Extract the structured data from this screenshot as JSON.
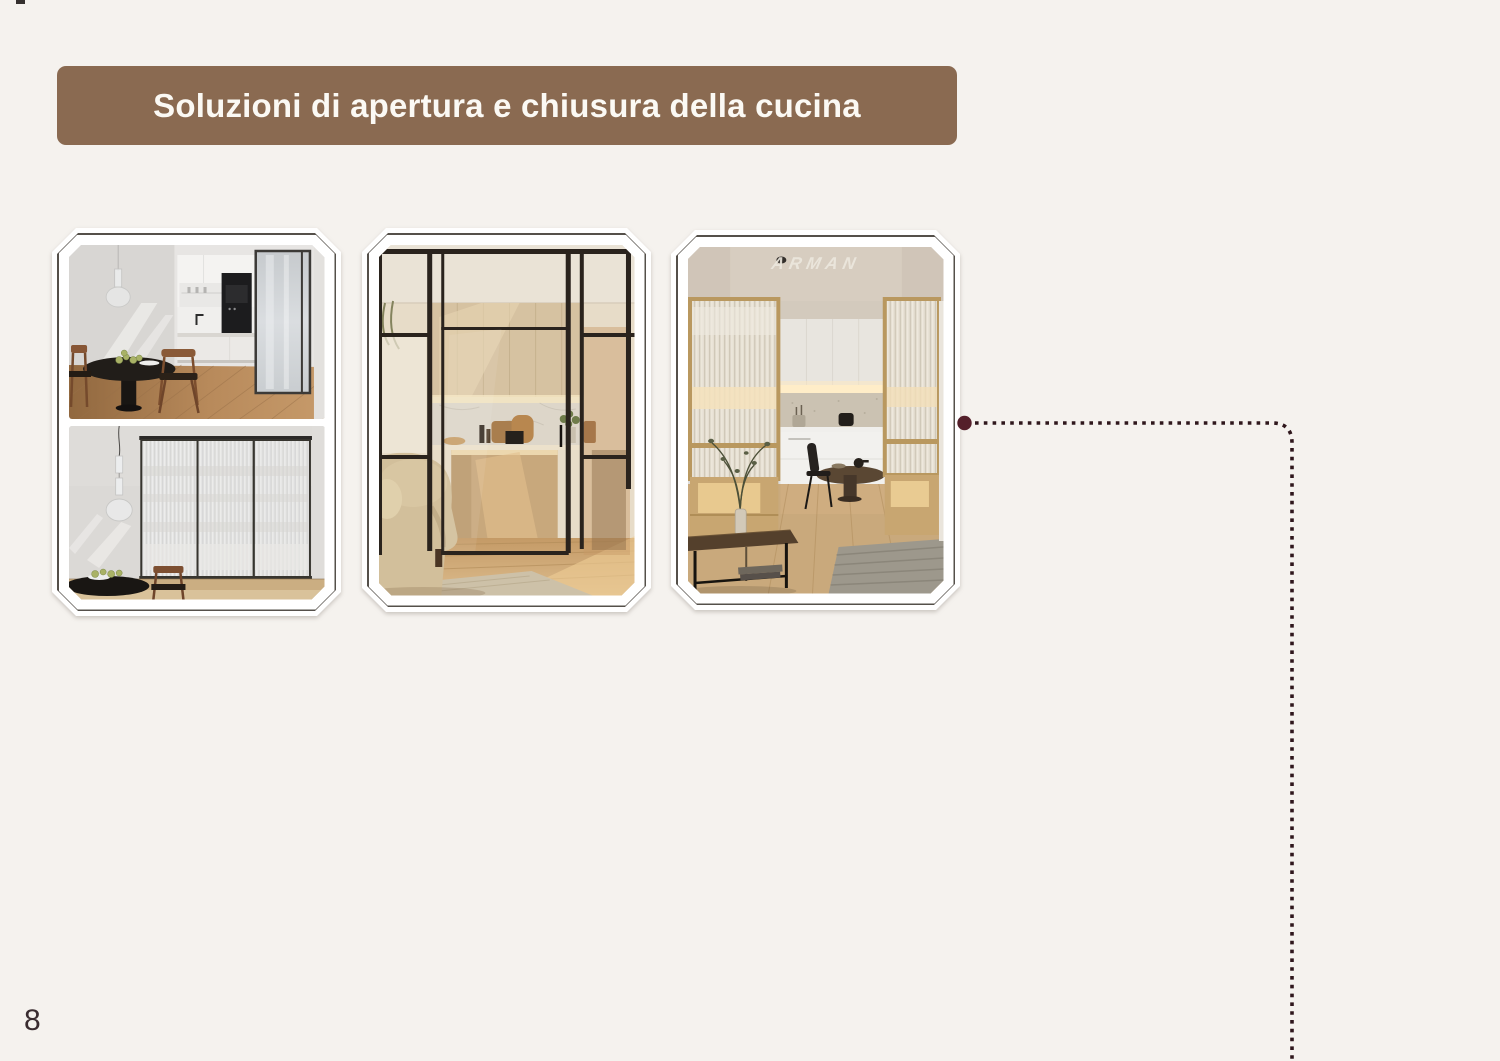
{
  "page": {
    "background": "#f5f2ee",
    "page_number": "8"
  },
  "header": {
    "title": "Soluzioni di apertura e chiusura della cucina",
    "bg_color": "#8a6a51",
    "text_color": "#fbf9f4"
  },
  "cards": [
    {
      "id": 1,
      "description": "cucina con porta scorrevole in vetro: vista aperta e vista chiusa"
    },
    {
      "id": 2,
      "description": "cucina con vetrata a telaio nero e porta scorrevole"
    },
    {
      "id": 3,
      "description": "cucina con vetrate cannettate e telaio in legno",
      "watermark": "ARMAN"
    }
  ],
  "connector": {
    "dot_color": "#541f2a",
    "line_color": "#2f171c"
  }
}
